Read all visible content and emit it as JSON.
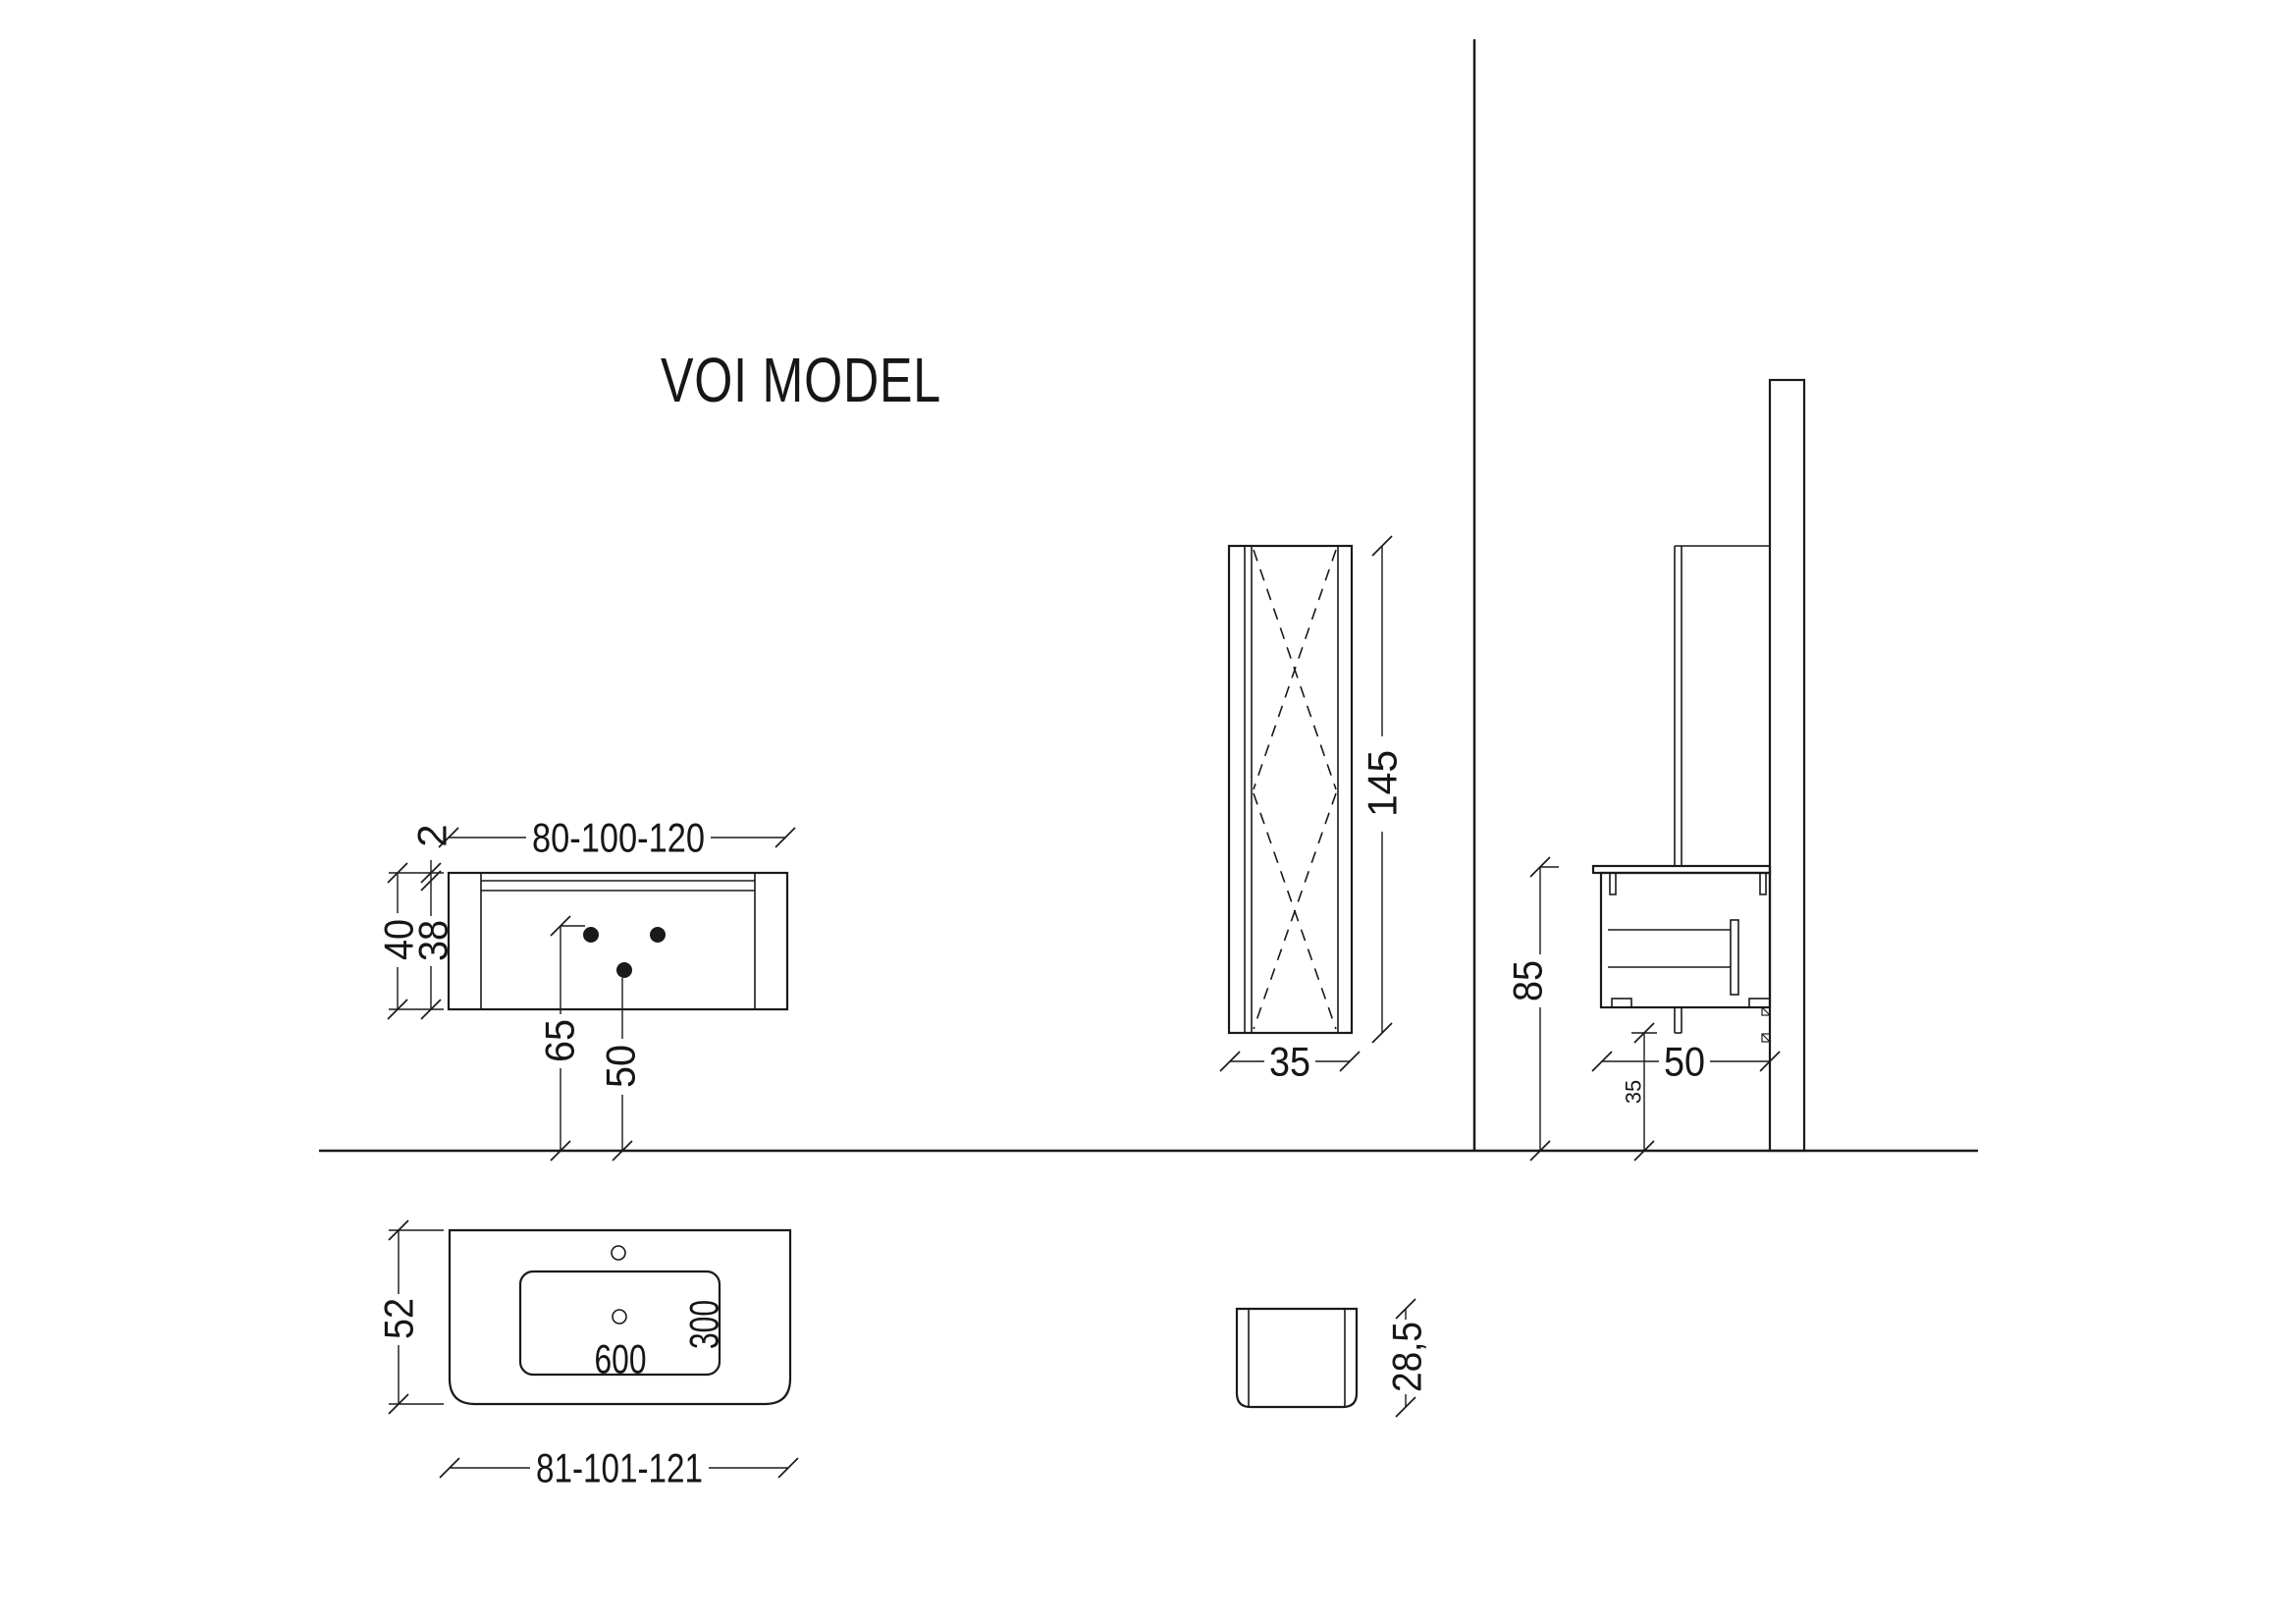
{
  "colors": {
    "ink": "#1a1a1a"
  },
  "title": "VOI MODEL",
  "front_view": {
    "width_label": "80-100-120",
    "top_thickness_label": "2",
    "total_height_label": "40",
    "body_height_label": "38",
    "faucet_holes_height_label": "65",
    "drain_height_label": "50"
  },
  "tall_cabinet_front": {
    "height_label": "145",
    "width_label": "35"
  },
  "side_view": {
    "worktop_height_label": "85",
    "depth_label": "50",
    "bottom_clearance_label": "35"
  },
  "basin_plan": {
    "depth_label": "52",
    "bowl_length_label": "600",
    "bowl_depth_label": "300",
    "width_label": "81-101-121"
  },
  "basin_section": {
    "height_label": "28,5"
  }
}
